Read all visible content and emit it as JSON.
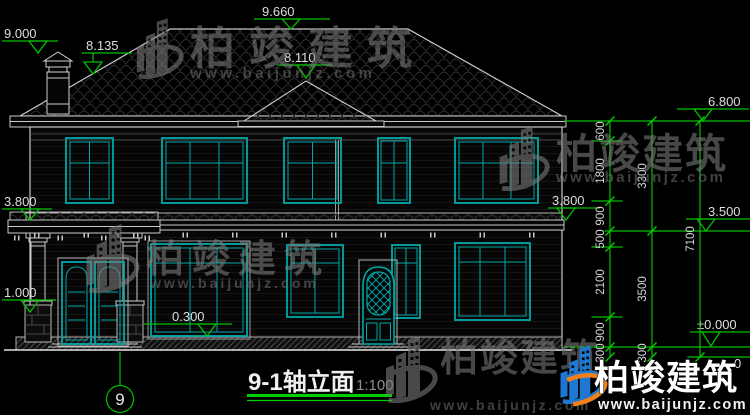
{
  "drawing": {
    "type": "architectural-elevation",
    "background": "#000000"
  },
  "titleblock": {
    "title": "9-1轴立面",
    "scale": "1:100"
  },
  "axis": {
    "bubble": "9"
  },
  "markers": {
    "m9000": "9.000",
    "m8135": "8.135",
    "m9660": "9.660",
    "m8110": "8.110",
    "m6800": "6.800",
    "m3800_left": "3.800",
    "m3800_right": "3.800",
    "m3500": "3.500",
    "m1000": "1.000",
    "m0300": "0.300",
    "mzero": "±0.000",
    "fragment": "0"
  },
  "dims": {
    "inner": [
      "600",
      "1800",
      "900",
      "500",
      "2100",
      "900",
      "300"
    ],
    "middle": [
      "3300",
      "3500",
      "300"
    ],
    "outer": [
      "7100"
    ]
  },
  "watermark": {
    "brand": "柏竣建筑",
    "url": "www.baijunjz.com"
  },
  "colors": {
    "line_white": "#c9c9c9",
    "window_teal": "#00a8a8",
    "dimension_green": "#00bf00",
    "watermark_gray": "#7d7d7d",
    "logo_blue": "#1e78d2",
    "logo_orange": "#f08019"
  }
}
